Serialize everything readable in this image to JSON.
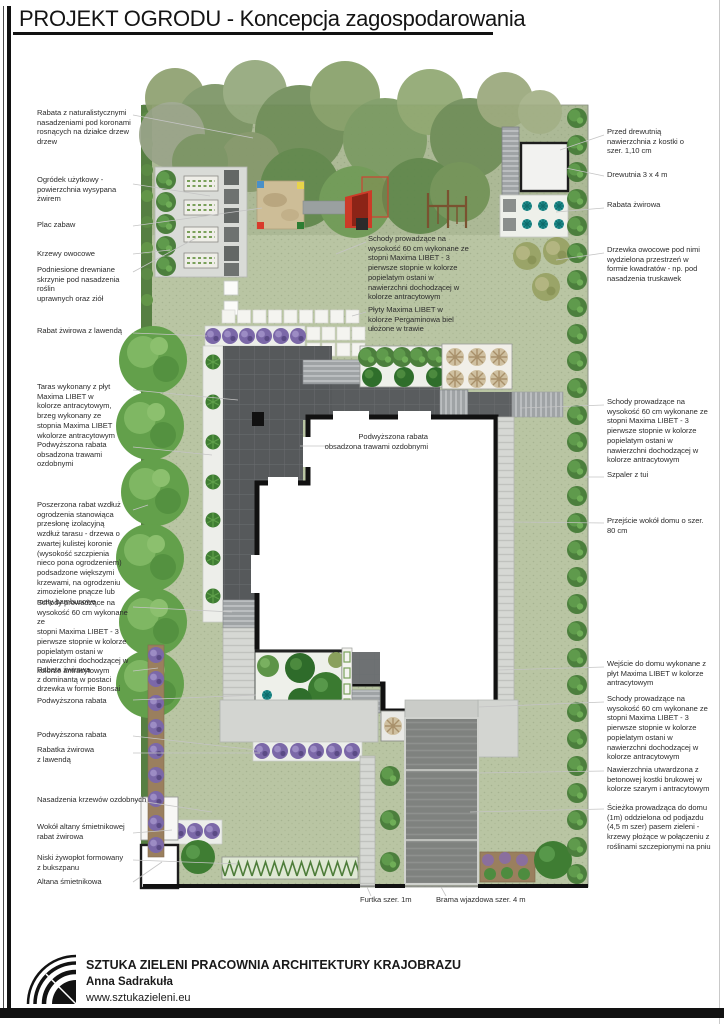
{
  "title": "PROJEKT OGRODU - Koncepcja zagospodarowania",
  "colors": {
    "lawn": "#b9c5a3",
    "terrace_anthracite": "#56595b",
    "paving_gray": "#d3d5d1",
    "driveway_gray": "#7f827f",
    "tree_green": "#4c7f3d",
    "lavender_purple": "#7b68a8",
    "teal_plant": "#1f8f8f",
    "sand_tan": "#cdbd97",
    "gravel_white": "#eef0ea",
    "bed_brown": "#9a7f5e"
  },
  "plan": {
    "annotations": {
      "left": [
        "Rabata z naturalistycznymi\nnasadzeniami pod koronami\nrosnących na działce drzew\ndrzew",
        "Ogródek użytkowy -\npowierzchnia wysypana\nżwirem",
        "Plac zabaw",
        "Krzewy owocowe",
        "Podniesione drewniane\nskrzynie pod nasadzenia roślin\nuprawnych oraz ziół",
        "Rabat żwirowa z lawendą",
        "Taras wykonany z płyt\nMaxima LIBET w\nkolorze antracytowym,\nbrzeg wykonany ze\nstopnia Maxima LIBET\nwkolorze antracytowym",
        "Podwyższona rabata\nobsadzona trawami\nozdobnymi",
        "Poszerzona rabat wzdłuż\nogrodzenia stanowiąca\nprzesłonę izolacyjną\nwzdłuż tarasu - drzewa o\nzwartej kulistej koronie\n(wysokość szczpienia\nnieco pona ogrodzeniem)\npodsadzone większymi\nkrzewami, na ogrodzeniu\nzimozielone pnącze lub\nmaty bambusowe",
        "Schody prowadzące na\nwysokość 60 cm wykonane ze\nstopni Maxima LIBET - 3\npierwsze stopnie w kolorze\npopielatym ostani w\nnawierzchni dochodzącej w\nkolorze antracytowym",
        "Rabata żwirowa\nz dominantą w postaci\ndrzewka w formie Bonsai",
        "Podwyższona rabata",
        "Podwyższona rabata",
        "Rabatka żwirowa\nz lawendą",
        "Nasadzenia krzewów ozdobnych",
        "Wokół altany śmietnikowej\nrabat żwirowa",
        "Niski żywopłot formowany\nz bukszpanu",
        "Altana śmietnikowa"
      ],
      "right": [
        "Przed drewutnią\nnawierzchnia z kostki o\nszer. 1,10 cm",
        "Drewutnia 3 x 4 m",
        "Rabata żwirowa",
        "Drzewka owocowe pod nimi\nwydzielona przestrzeń w\nformie kwadratów - np. pod\nnasadzenia truskawek",
        "Schody prowadzące na\nwysokość 60 cm wykonane ze\nstopni Maxima LIBET - 3\npierwsze stopnie w kolorze\npopielatym ostani w\nnawierzchni dochodzącej w\nkolorze antracytowym",
        "Szpaler z tui",
        "Przejście wokół domu o szer.\n80 cm",
        "Wejście do domu wykonane z\npłyt Maxima LIBET w kolorze\nantracytowym",
        "Schody prowadzące na\nwysokość 60 cm wykonane ze\nstopni Maxima LIBET - 3\npierwsze stopnie w kolorze\npopielatym ostani w\nnawierzchni dochodzącej w\nkolorze antracytowym",
        "Nawierzchnia utwardzona z\nbetonowej kostki brukowej w\nkolorze szarym i antracytowym",
        "Ścieżka prowadząca do domu\n(1m)  oddzielona od podjazdu\n(4,5 m szer) pasem zieleni -\nkrzewy płożące w połączeniu z\nroślinami szczepionymi na pniu"
      ],
      "center": [
        "Schody prowadzące na\nwysokość 60 cm wykonane ze\nstopni Maxima LIBET - 3\npierwsze stopnie w kolorze\npopielatym ostani w\nnawierzchni dochodzącej w\nkolorze antracytowym",
        "Płyty Maxima LIBET w\nkolorze Pergaminowa biel\nułożone w trawie",
        "Podwyższona rabata\nobsadzona trawami ozdobnymi"
      ],
      "bottom": [
        "Furtka szer. 1m",
        "Brama wjazdowa szer. 4 m"
      ]
    }
  },
  "footer": {
    "company": "SZTUKA ZIELENI PRACOWNIA ARCHITEKTURY KRAJOBRAZU",
    "author": "Anna Sadrakuła",
    "website": "www.sztukazieleni.eu"
  }
}
